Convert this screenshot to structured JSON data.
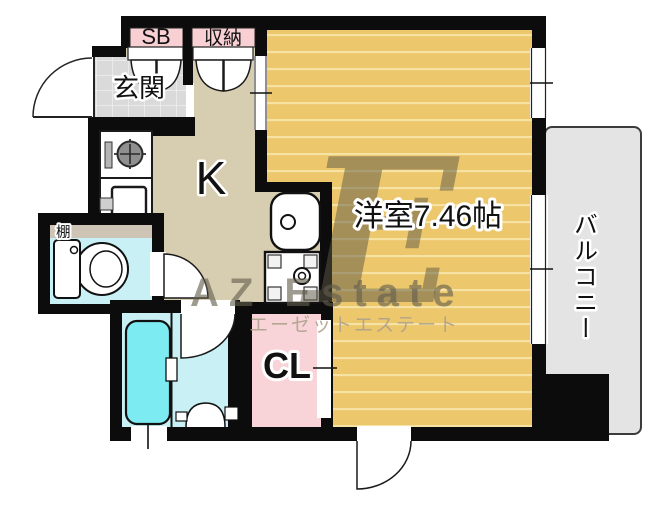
{
  "plan": {
    "rooms": {
      "entrance": "玄関",
      "kitchen": "K",
      "western_room": "洋室7.46帖",
      "balcony": "バルコニー",
      "closet": "CL",
      "storage": "収納",
      "shoe_box": "SB",
      "shelf": "棚"
    },
    "watermark": {
      "logo_letter": "E",
      "company_en": "AZ Estate",
      "company_jp": "エーゼットエステート"
    },
    "colors": {
      "wall": "#0c0c0c",
      "flooring": "#ecc76c",
      "flooring_stripe": "#f6e3a3",
      "kitchen_floor": "#d7cdb0",
      "entrance_tile": "#dadada",
      "balcony": "#e4e4e4",
      "wet_area": "#c9f1f5",
      "bathtub": "#7debf2",
      "closet_pink": "#f8d3d7",
      "label_pink": "#f8cfd3"
    }
  }
}
